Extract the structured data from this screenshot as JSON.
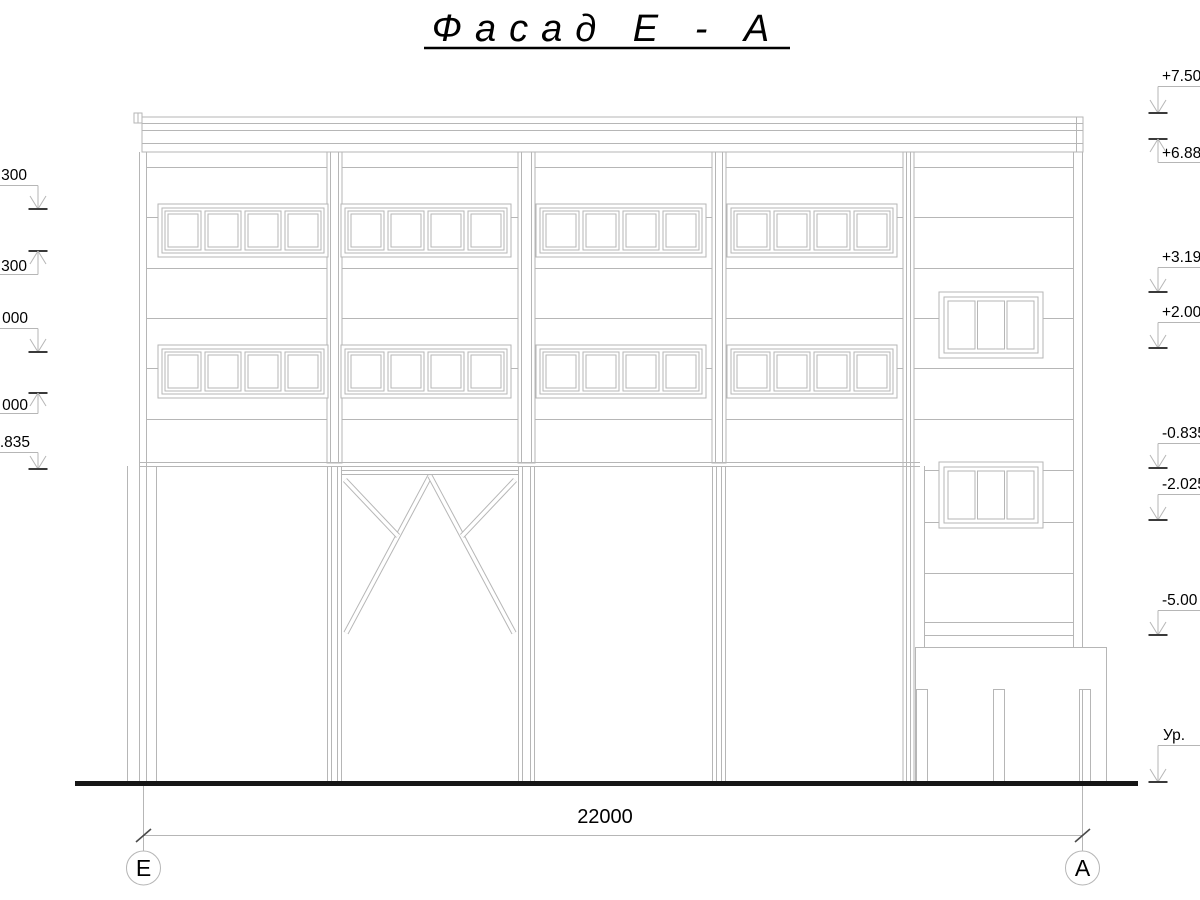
{
  "title": "Фасад Е - А",
  "dimension": {
    "value": "22000"
  },
  "axes": {
    "left": "Е",
    "right": "А"
  },
  "elevations_left": [
    {
      "label": "300"
    },
    {
      "label": "300"
    },
    {
      "label": "000"
    },
    {
      "label": "000"
    },
    {
      "label": ".835"
    }
  ],
  "elevations_right": [
    {
      "label": "+7.50"
    },
    {
      "label": "+6.88"
    },
    {
      "label": "+3.19"
    },
    {
      "label": "+2.00"
    },
    {
      "label": "-0.835"
    },
    {
      "label": "-2.025"
    },
    {
      "label": "-5.00"
    },
    {
      "label": "Ур."
    }
  ],
  "colors": {
    "drawing_line": "#b6b6b6",
    "level_tick": "#3a3a3a",
    "ground_line": "#161616",
    "text": "#000000",
    "background": "#ffffff"
  }
}
